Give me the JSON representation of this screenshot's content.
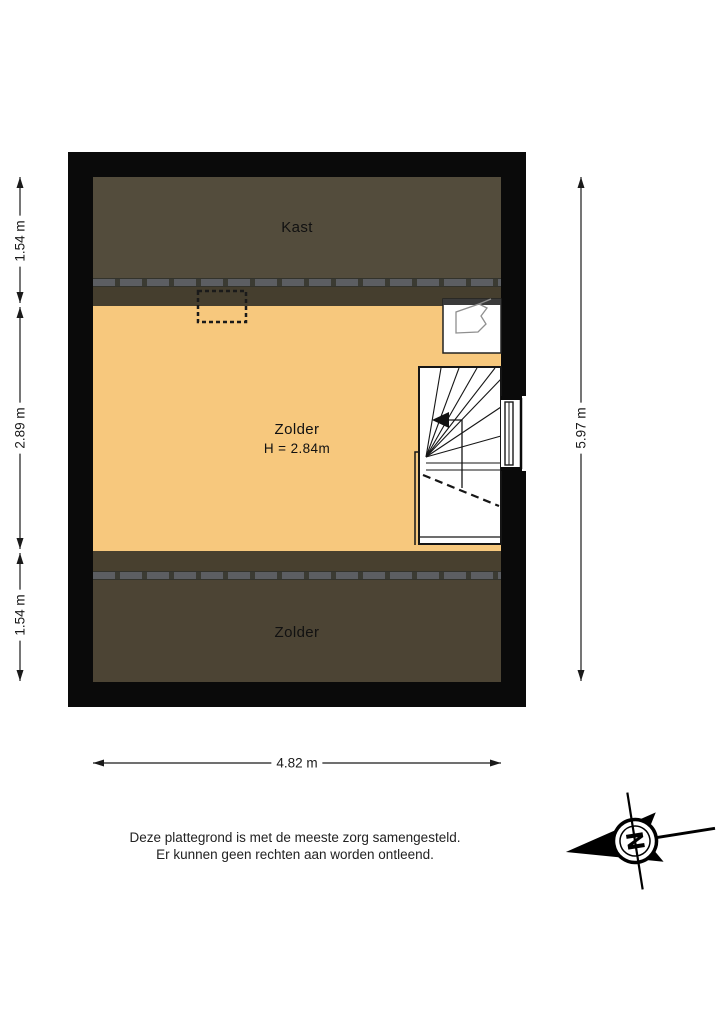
{
  "title": "Plattegrond zolderverdieping",
  "rooms": {
    "kast": {
      "label": "Kast"
    },
    "zolder_mid": {
      "label": "Zolder",
      "height_label": "H = 2.84m"
    },
    "zolder_bottom": {
      "label": "Zolder"
    }
  },
  "dimensions": {
    "left_top": "1.54 m",
    "left_middle": "2.89 m",
    "left_bottom": "1.54 m",
    "right": "5.97 m",
    "bottom": "4.82 m"
  },
  "footer": {
    "line1": "Deze plattegrond is met de meeste zorg samengesteld.",
    "line2": "Er kunnen geen rechten aan worden ontleend."
  },
  "compass": {
    "north_letter": "N"
  },
  "colors": {
    "wall": "#0a0a0a",
    "room_dark_brown": "#534C3C",
    "room_strip_brown": "#453E2E",
    "room_bottom_brown": "#4C4434",
    "floor_orange": "#F7C87D",
    "headroom_dash": "#5C5E62"
  }
}
